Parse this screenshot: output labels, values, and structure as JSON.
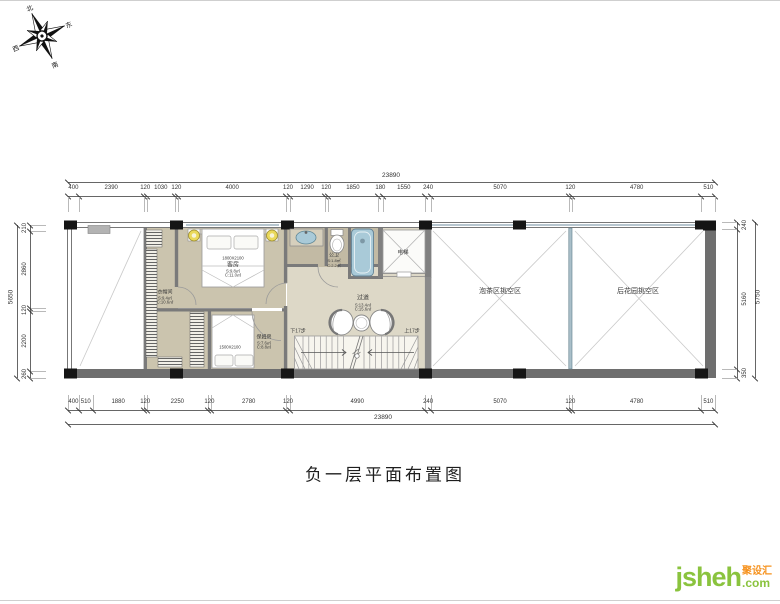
{
  "page": {
    "title_caption": "负一层平面布置图"
  },
  "compass": {
    "north": "北",
    "south": "南",
    "east": "东",
    "west": "西"
  },
  "watermark": {
    "name": "jsheh",
    "tld": ".com",
    "cn_tag": "聚设汇"
  },
  "rooms": {
    "cloakroom": {
      "name": "衣帽间",
      "area_s": "S:9.4㎡",
      "area_c": "C:10.6㎡"
    },
    "guest": {
      "name": "客房",
      "area_s": "S:9.8㎡",
      "area_c": "C:11.0㎡"
    },
    "nanny": {
      "name": "保姆房",
      "area_s": "S:7.6㎡",
      "area_c": "C:8.8㎡"
    },
    "bath": {
      "name": "公卫",
      "area_s": "S:1.8㎡",
      "area_c": "C:2.2㎡"
    },
    "elevator": {
      "name": "电梯"
    },
    "corridor": {
      "name": "过道",
      "area_s": "S:13.4㎡",
      "area_c": "C:15.6㎡"
    },
    "tea_void": {
      "name": "泡茶区挑空区"
    },
    "garden_void": {
      "name": "后花园挑空区"
    }
  },
  "fixtures": {
    "guest_bed_size": "1800X2100",
    "nanny_bed_size": "1500X2100"
  },
  "stairs": {
    "down": "下17步",
    "up": "上17步"
  },
  "dimensions": {
    "top": {
      "total": 23890,
      "segments": [
        400,
        2390,
        120,
        1030,
        120,
        4000,
        120,
        1290,
        120,
        1850,
        180,
        1550,
        240,
        5070,
        120,
        4780,
        510
      ]
    },
    "bottom": {
      "total": 23890,
      "segments": [
        400,
        510,
        1880,
        120,
        2250,
        120,
        2780,
        120,
        4990,
        240,
        5070,
        120,
        4780,
        510
      ]
    },
    "left": {
      "total": 5650,
      "segments": [
        210,
        2860,
        120,
        2200,
        260
      ]
    },
    "right": {
      "total": 5750,
      "segments": [
        240,
        5160,
        350
      ]
    }
  },
  "colors": {
    "floor_tan": "#cbc4ae",
    "floor_light": "#ddd8c7",
    "fixture_blue": "#a9cad8",
    "wall_gray": "#6e6e6e",
    "logo_green": "#8ac33e",
    "logo_orange": "#f6921e"
  }
}
